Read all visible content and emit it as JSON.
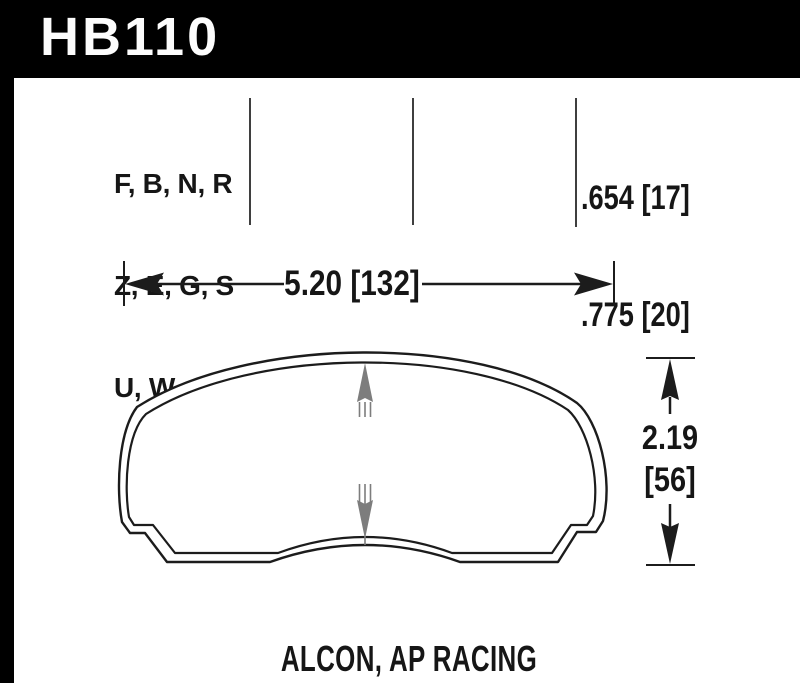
{
  "header": {
    "part_number": "HB110"
  },
  "compounds": {
    "line1": "F, B, N, R",
    "line2": "Z, E, G, S",
    "line3": "U, W"
  },
  "thickness": {
    "value1": ".654 [17]",
    "value2": ".775 [20]"
  },
  "width_dim": {
    "label": "5.20 [132]"
  },
  "center_dim": {
    "line1": "1.98",
    "line2": "[50]"
  },
  "height_dim": {
    "line1": "2.19",
    "line2": "[56]"
  },
  "footer": {
    "application": "ALCON, AP RACING"
  },
  "colors": {
    "header_bg": "#000000",
    "header_text": "#fcfcfc",
    "line_black": "#1c1c1c",
    "column_line": "#3f3f3f",
    "dim_gray": "#7d7d7d",
    "background": "#ffffff"
  }
}
